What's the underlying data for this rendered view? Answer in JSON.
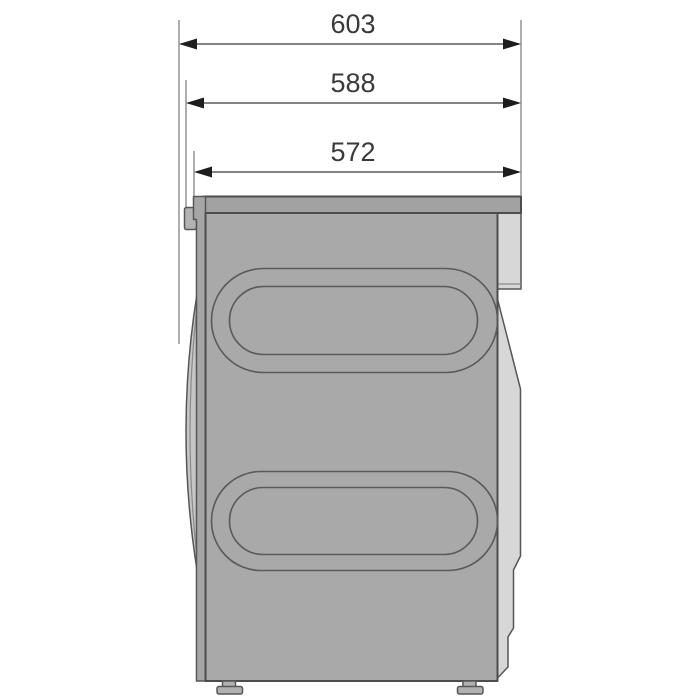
{
  "diagram": {
    "kind": "appliance-side-view-dimension-drawing",
    "dimensions": [
      {
        "value": "603"
      },
      {
        "value": "588"
      },
      {
        "value": "572"
      }
    ],
    "colors": {
      "background": "#ffffff",
      "body": "#a9a9a9",
      "lid": "#a2a2a2",
      "front_frame": "#a6a6a6",
      "door": "#c6c6c6",
      "knob": "#b3b3b3",
      "rear_panel": "#d7d7d7",
      "feet": "#b0b0b0",
      "outline": "#4d4d4d",
      "dimension_line": "#3a3a3a",
      "label_text": "#3a3a3a"
    }
  }
}
